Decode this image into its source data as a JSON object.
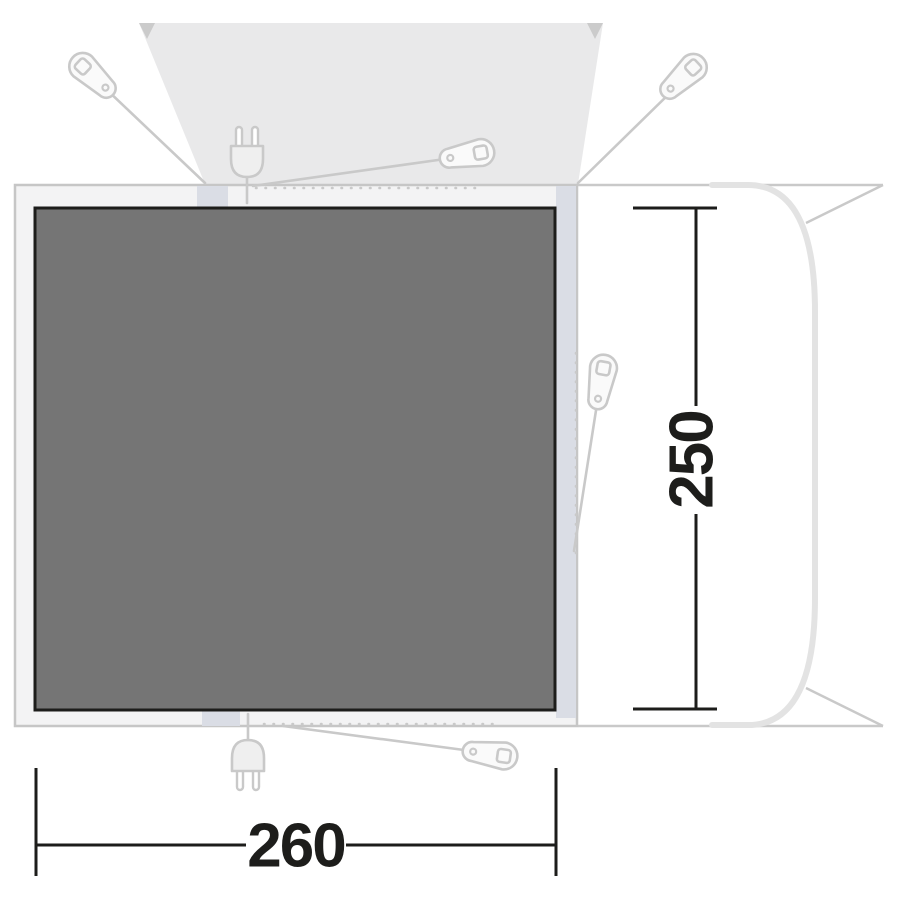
{
  "diagram": {
    "type": "awning-floorplan-top-view",
    "labels": {
      "width": "260",
      "depth": "250"
    },
    "colors": {
      "background": "#ffffff",
      "groundsheet_fill": "#757575",
      "groundsheet_border": "#1d1d1b",
      "footprint_fill": "#f3f3f4",
      "footprint_border": "#c6c6c6",
      "connection_band_fill": "#dadde5",
      "canopy_fill": "#e9e9ea",
      "canopy_corner": "#cbcbcb",
      "icon_stroke": "#c9c9c9",
      "icon_fill": "#fafafa",
      "vehicle_body_stroke": "#e3e3e3",
      "vehicle_line_stroke": "#c9c9c9",
      "dimension_color": "#1d1d1b"
    },
    "icons": [
      "tent-peg-icon-top-left",
      "tent-peg-icon-top-middle",
      "tent-peg-icon-top-right",
      "tent-peg-icon-right-side",
      "tent-peg-icon-bottom",
      "power-plug-icon-top",
      "power-plug-icon-bottom"
    ]
  }
}
